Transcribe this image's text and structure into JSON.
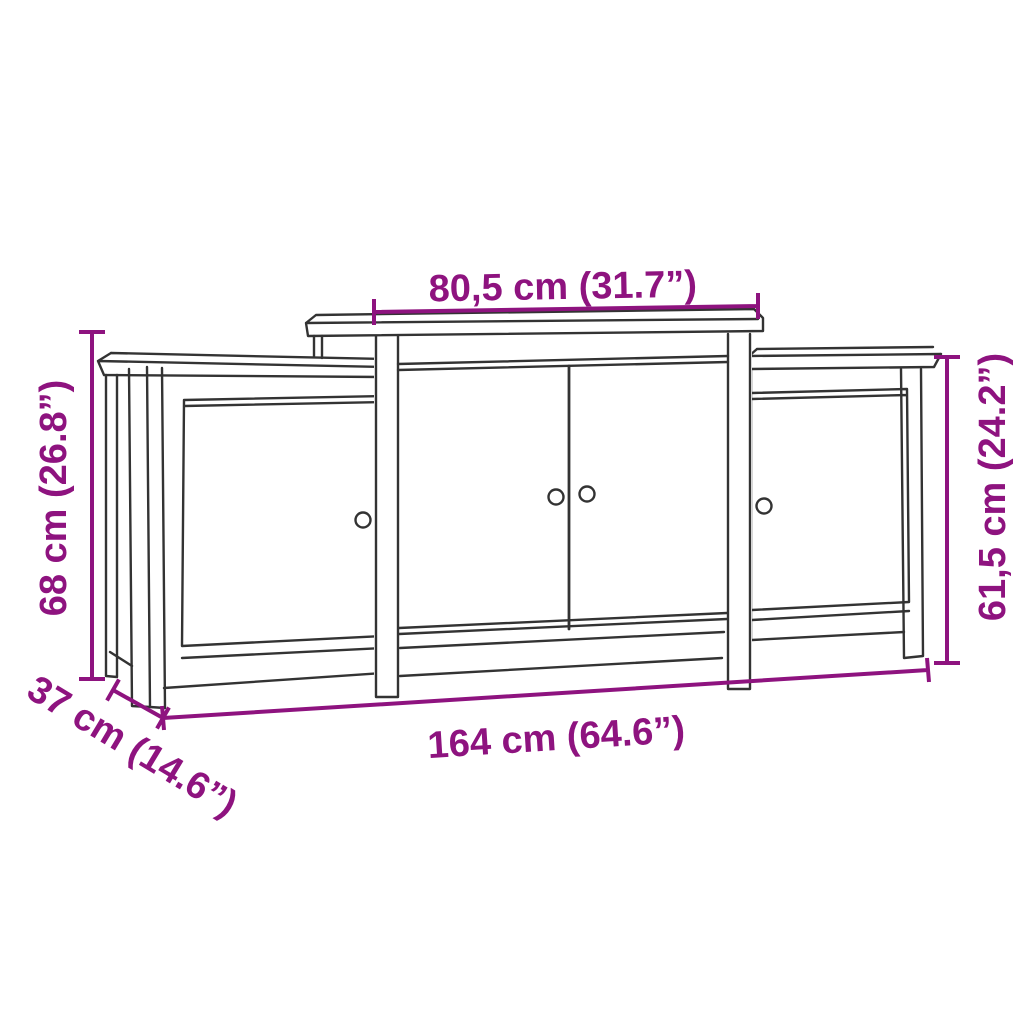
{
  "figure": {
    "type": "product-dimension-line-drawing",
    "subject": "sideboard with raised center section and 4 doors"
  },
  "diagram": {
    "style": {
      "dimension_color": "#8E137F",
      "outline_color": "#333333",
      "background": "#FFFFFF"
    },
    "dimensions": {
      "top_width": {
        "label": "80,5 cm (31.7”)",
        "cm": 80.5,
        "inches": 31.7
      },
      "left_height": {
        "label": "68 cm (26.8”)",
        "cm": 68,
        "inches": 26.8
      },
      "right_height": {
        "label": "61,5 cm (24.2”)",
        "cm": 61.5,
        "inches": 24.2
      },
      "depth": {
        "label": "37 cm (14.6”)",
        "cm": 37,
        "inches": 14.6
      },
      "total_width": {
        "label": "164 cm (64.6”)",
        "cm": 164,
        "inches": 64.6
      }
    }
  }
}
